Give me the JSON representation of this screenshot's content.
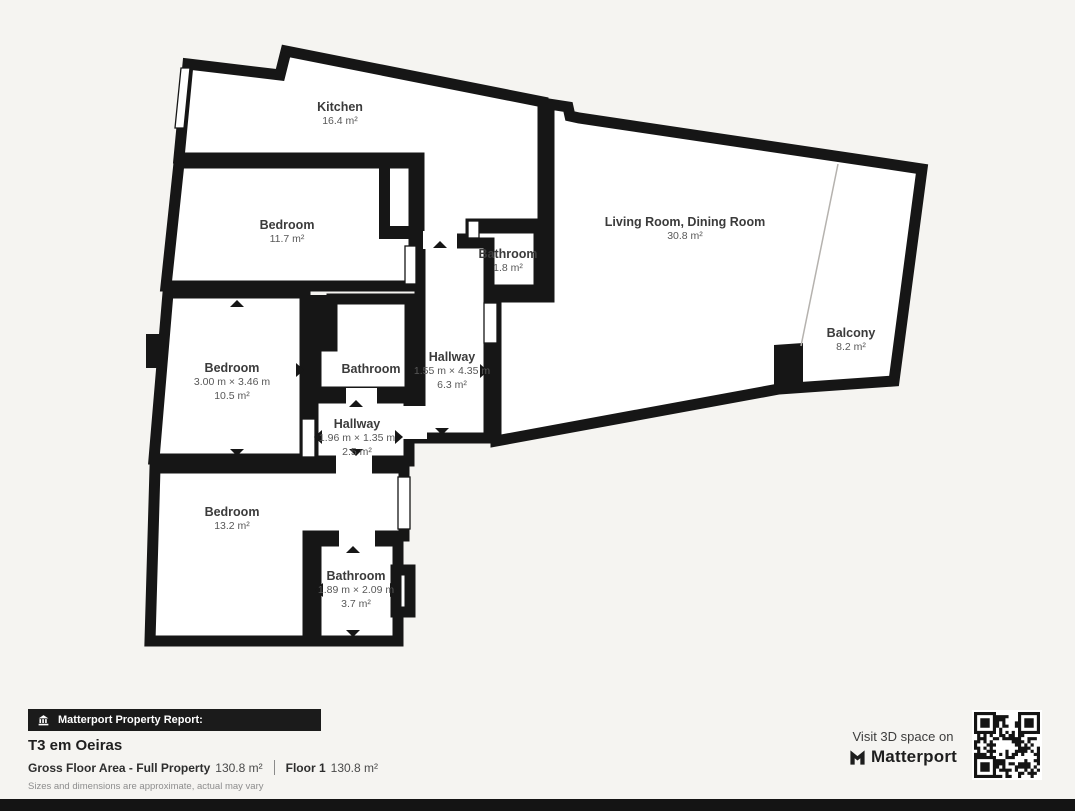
{
  "plan": {
    "rooms": {
      "kitchen": {
        "name": "Kitchen",
        "area": "16.4 m²"
      },
      "bedroom1": {
        "name": "Bedroom",
        "area": "11.7 m²"
      },
      "bathroom_top": {
        "name": "Bathroom",
        "area": "1.8 m²"
      },
      "living_room": {
        "name": "Living Room, Dining Room",
        "area": "30.8 m²"
      },
      "balcony": {
        "name": "Balcony",
        "area": "8.2 m²"
      },
      "bedroom2": {
        "name": "Bedroom",
        "dims": "3.00 m × 3.46 m",
        "area": "10.5 m²"
      },
      "bathroom_mid": {
        "name": "Bathroom"
      },
      "hallway_main": {
        "name": "Hallway",
        "dims": "1.55 m × 4.35 m",
        "area": "6.3 m²"
      },
      "hallway_small": {
        "name": "Hallway",
        "dims": "1.96 m × 1.35 m",
        "area": "2.5 m²"
      },
      "bedroom3": {
        "name": "Bedroom",
        "area": "13.2 m²"
      },
      "bathroom_bottom": {
        "name": "Bathroom",
        "dims": "1.89 m × 2.09 m",
        "area": "3.7 m²"
      }
    },
    "colors": {
      "wall": "#161616",
      "room_fill": "#ffffff",
      "background": "#f5f4f1"
    }
  },
  "footer": {
    "banner": "Matterport Property Report:",
    "title": "T3 em Oeiras",
    "gross_label": "Gross Floor Area - Full Property",
    "gross_value": "130.8 m²",
    "floor_label": "Floor 1",
    "floor_value": "130.8 m²",
    "disclaimer": "Sizes and dimensions are approximate, actual may vary",
    "visit_text": "Visit 3D space on",
    "brand": "Matterport",
    "icons": [
      "building-icon",
      "matterport-m-icon",
      "qr-code"
    ]
  }
}
